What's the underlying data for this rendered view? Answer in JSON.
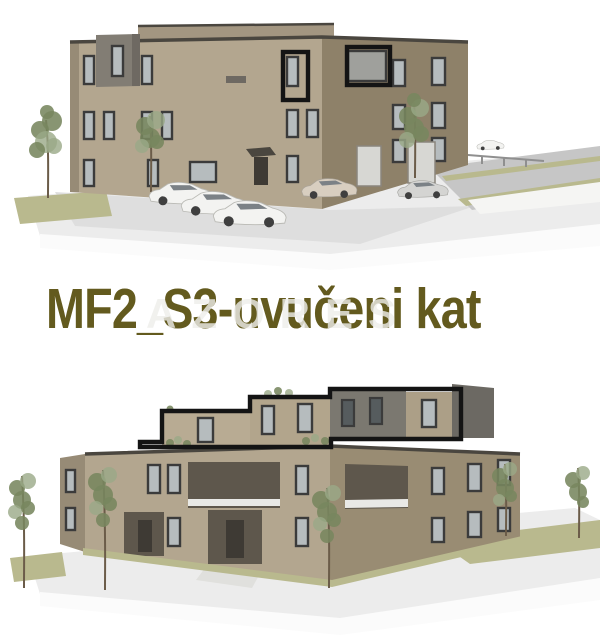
{
  "caption": {
    "title": {
      "text": "MF2_S3-uvučeni kat"
    },
    "watermark": {
      "text": "AZORES"
    }
  },
  "renders": {
    "top": {
      "name": "building-render-variant-flat-roof",
      "annotation": "two-top-floor-windows-outlined-black",
      "cars_parked": 6,
      "trees": 3
    },
    "bottom": {
      "name": "building-render-variant-recessed-top-floor",
      "annotation": "recessed-top-floor-outlined-black",
      "cars_parked": 1,
      "trees": 5
    }
  },
  "colors": {
    "background": "#ffffff",
    "title": "#635a1e",
    "watermark": "#eeeeeb",
    "facade_front": "#b3a68f",
    "facade_side": "#8e8169",
    "facade_side_b": "#998c73",
    "facade_left": "#978b76",
    "rear_wing": "#a39681",
    "top_tan_a": "#b8ab93",
    "top_tan_b": "#b2a58c",
    "top_tan_d": "#ac9f87",
    "top_gray": "#7b7870",
    "top_gray_dark": "#6c6963",
    "roof_line": "#4a463f",
    "gray_box": "#827d74",
    "gray_box_shade": "#6e6962",
    "window_frame": "#3b3b3b",
    "glass": "#b6bcbe",
    "glass_dark": "#565c5e",
    "recess": "#5e574c",
    "recess_dark": "#3e3a34",
    "railing": "#e9e9e6",
    "ground": "#ececec",
    "apron": "#dedede",
    "pavement_white": "#fbfbfb",
    "road": "#c6c6c6",
    "wall_white": "#f5f5f3",
    "grass": "#b9b98e",
    "walkway": "#e0e0dd",
    "tree": "#77865f",
    "tree_light": "#9aa987",
    "trunk": "#6b5c49",
    "car_white": "#f3f3f1",
    "car_beige": "#d8cec0",
    "car_silver": "#d4d4d2",
    "car_glass": "#7b8186",
    "wheel": "#3f3f3f",
    "guardrail": "#8f8f8f",
    "garage": "#d7d7d3",
    "annotation": "#141414"
  }
}
